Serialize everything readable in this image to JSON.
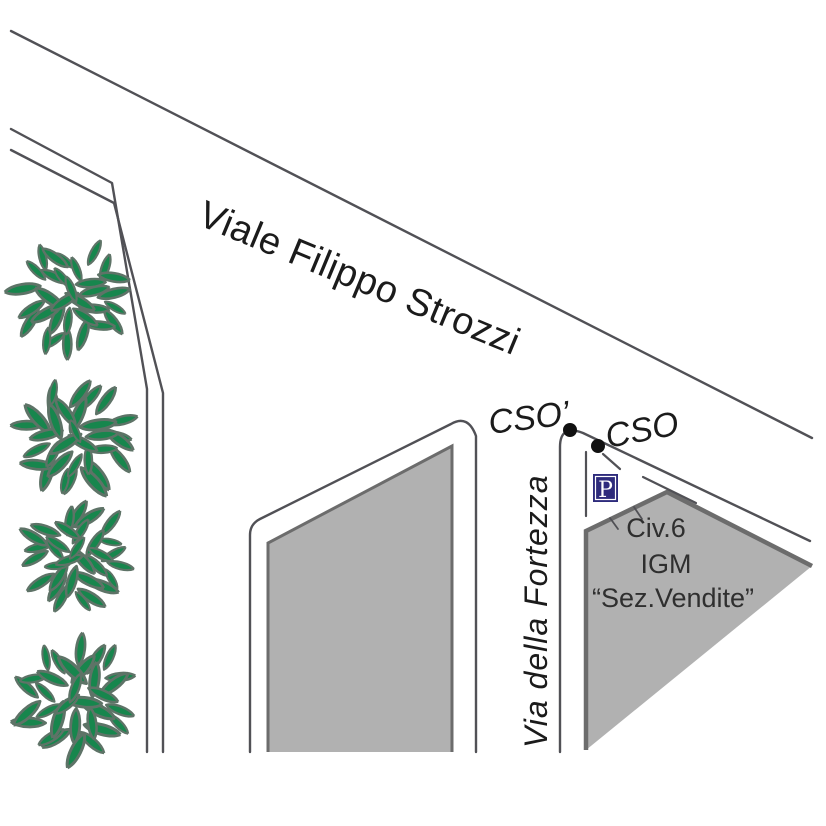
{
  "map": {
    "streets": {
      "main_road": "Viale Filippo Strozzi",
      "cross_road": "Via della Fortezza"
    },
    "markers": {
      "cso_prime": "CSO’",
      "cso": "CSO",
      "parking_letter": "P"
    },
    "building_label": {
      "line1": "Civ.6",
      "line2": "IGM",
      "line3": "“Sez.Vendite”"
    },
    "colors": {
      "leaf_green": "#17864d",
      "leaf_edge": "#5e7367",
      "block_fill": "#b1b1b1",
      "block_border": "#6c6c6c",
      "line_gray": "#515156",
      "text_black": "#1b1b1b",
      "label_gray": "#2f2f2f",
      "parking_blue": "#2e2b7c",
      "dot_black": "#111111",
      "white": "#ffffff"
    }
  }
}
